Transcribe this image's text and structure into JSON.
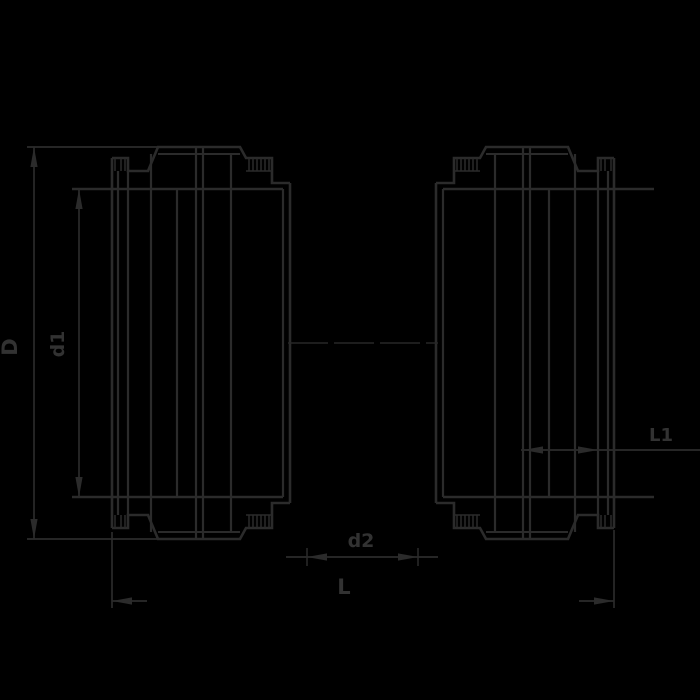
{
  "canvas": {
    "width": 700,
    "height": 700,
    "background": "#000000"
  },
  "drawing": {
    "description": "Cross-section technical drawing of two mirrored pipe coupling sockets with dimension lines",
    "line_color": "#2b2b2b",
    "text_color": "#323232",
    "dimensions": {
      "outer_diameter": {
        "label": "D"
      },
      "inner_diameter": {
        "label": "d1"
      },
      "socket_depth": {
        "label": "L1"
      },
      "bore": {
        "label": "d2"
      },
      "overall_length": {
        "label": "L"
      }
    }
  }
}
